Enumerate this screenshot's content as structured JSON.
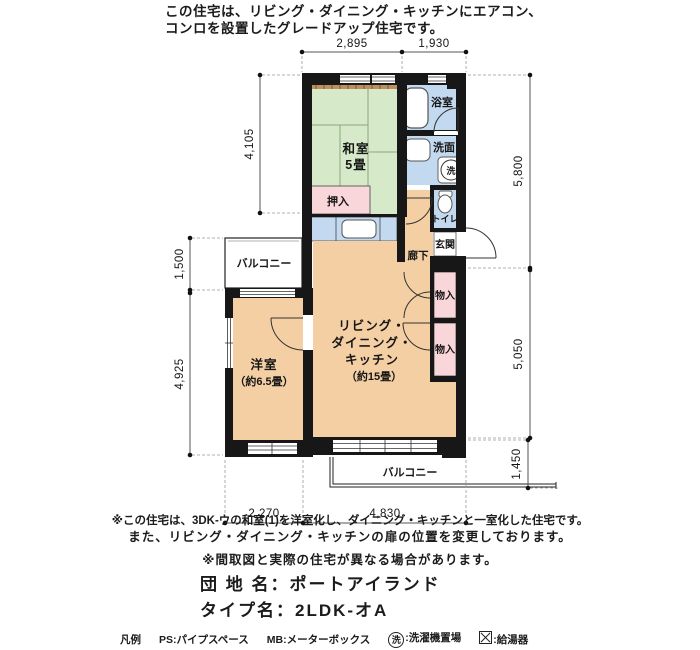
{
  "header": {
    "line1": "この住宅は、リビング・ダイニング・キッチンにエアコン、",
    "line2": "コンロを設置したグレードアップ住宅です。"
  },
  "plan": {
    "rooms": {
      "washitsu_name": "和室",
      "washitsu_size": "5畳",
      "oshiire": "押入",
      "yoshitsu_name": "洋室",
      "yoshitsu_size": "（約6.5畳）",
      "ldk_line1": "リビング・",
      "ldk_line2": "ダイニング・",
      "ldk_line3": "キッチン",
      "ldk_line4": "（約15畳）",
      "bath": "浴室",
      "senmen": "洗面",
      "toilet": "トイレ",
      "genkan": "玄関",
      "rouka": "廊下",
      "mononyu_upper": "物入",
      "mononyu_lower": "物入",
      "balcony_upper": "バルコニー",
      "balcony_lower": "バルコニー",
      "washer_symbol": "洗"
    },
    "dimensions": {
      "top1": "2,895",
      "top2": "1,930",
      "left1": "4,105",
      "left2": "1,500",
      "left3": "4,925",
      "right1": "5,800",
      "right2": "5,050",
      "right3": "1,450",
      "bottom1": "2,270",
      "bottom2": "4,830"
    },
    "colors": {
      "tatami": "#d6e9c8",
      "wood_floor": "#f5cfa4",
      "closet_pink": "#f9d6da",
      "water_blue": "#c3d9ef",
      "wall": "#171717",
      "shelf_brown": "#bb8f60"
    }
  },
  "notes": {
    "note1": "※この住宅は、3DK-ウの和室(1)を洋室化し、ダイニング・キッチンと一室化した住宅です。",
    "note2": "また、リビング・ダイニング・キッチンの扉の位置を変更しております。",
    "note3": "※間取図と実際の住宅が異なる場合があります。"
  },
  "title": {
    "danchi_label": "団 地 名：",
    "danchi_value": "ポートアイランド",
    "type_label": "タイプ名：",
    "type_value": "2LDK-オA"
  },
  "legend": {
    "heading": "凡例",
    "ps": "PS:パイプスペース",
    "mb": "MB:メーターボックス",
    "washer_symbol": "洗",
    "washer_label": ":洗濯機置場",
    "heater_label": ":給湯器"
  }
}
